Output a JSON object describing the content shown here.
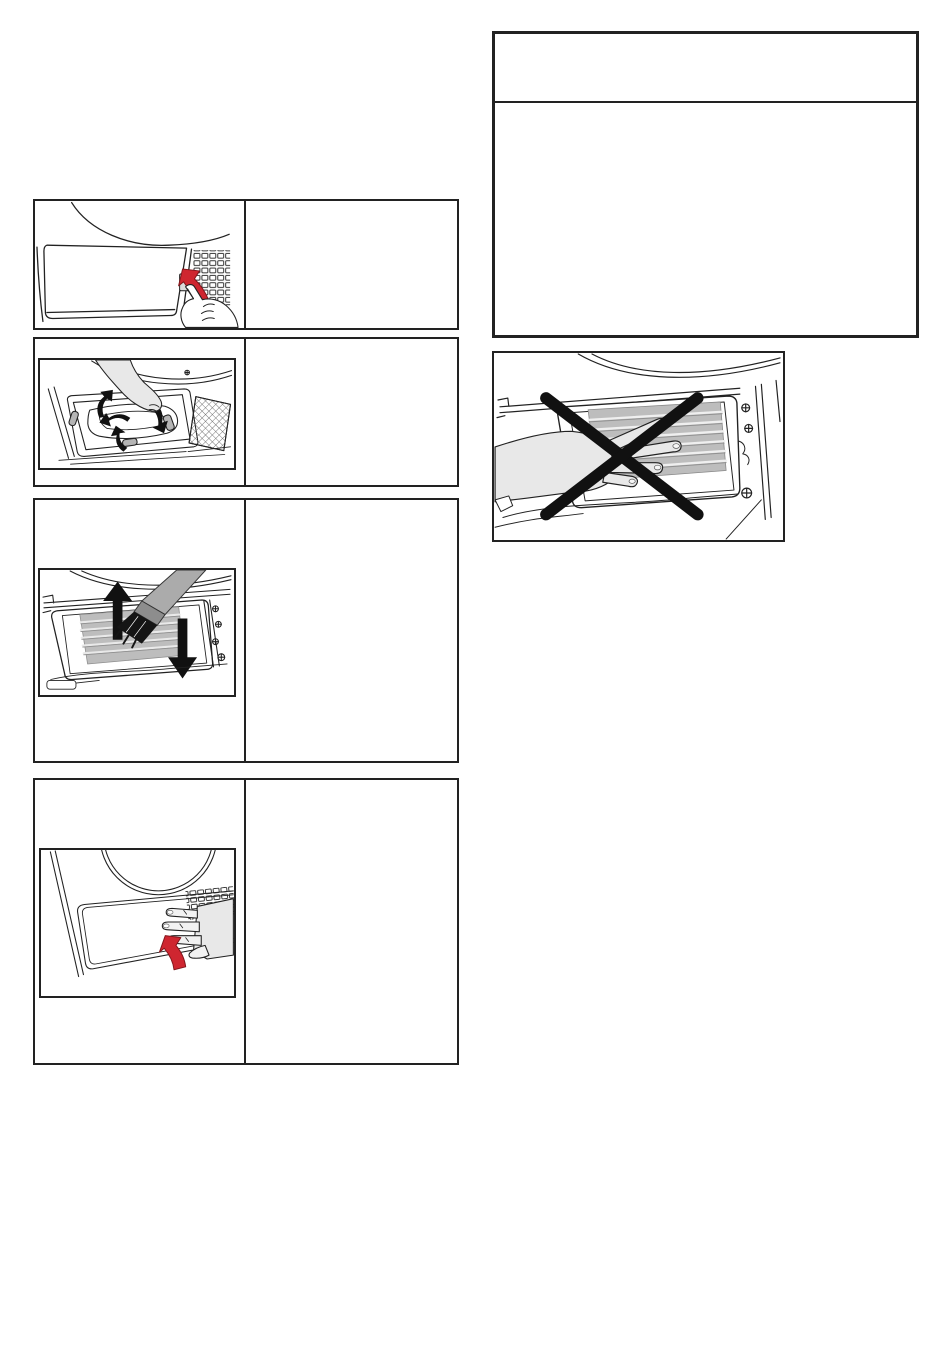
{
  "page": {
    "width": 950,
    "height": 1364,
    "background": "#ffffff",
    "kind": "appliance-manual-maintenance-page"
  },
  "colors": {
    "page_bg": "#ffffff",
    "line": "#222222",
    "accent_red": "#cf2630",
    "accent_red_dark": "#82161c",
    "fin_gray": "#bdbdbd",
    "fin_gray_dark": "#8f8f8f",
    "hand_gray": "#e8e8e8",
    "metal_gray": "#ababab",
    "ink_black": "#111111"
  },
  "steps": [
    {
      "id": 1,
      "illustration": "press-red-latch-to-open-service-flap",
      "caption": ""
    },
    {
      "id": 2,
      "illustration": "turn-four-locking-levers-with-hand",
      "caption": ""
    },
    {
      "id": 3,
      "illustration": "vacuum-heat-exchanger-fins-up-down",
      "caption": ""
    },
    {
      "id": 4,
      "illustration": "press-service-flap-closed-red-arrow",
      "caption": ""
    }
  ],
  "notice_box": {
    "header_text": "",
    "body_text": ""
  },
  "prohibition_figure": {
    "illustration": "do-not-touch-heat-exchanger-fins-with-hand"
  }
}
